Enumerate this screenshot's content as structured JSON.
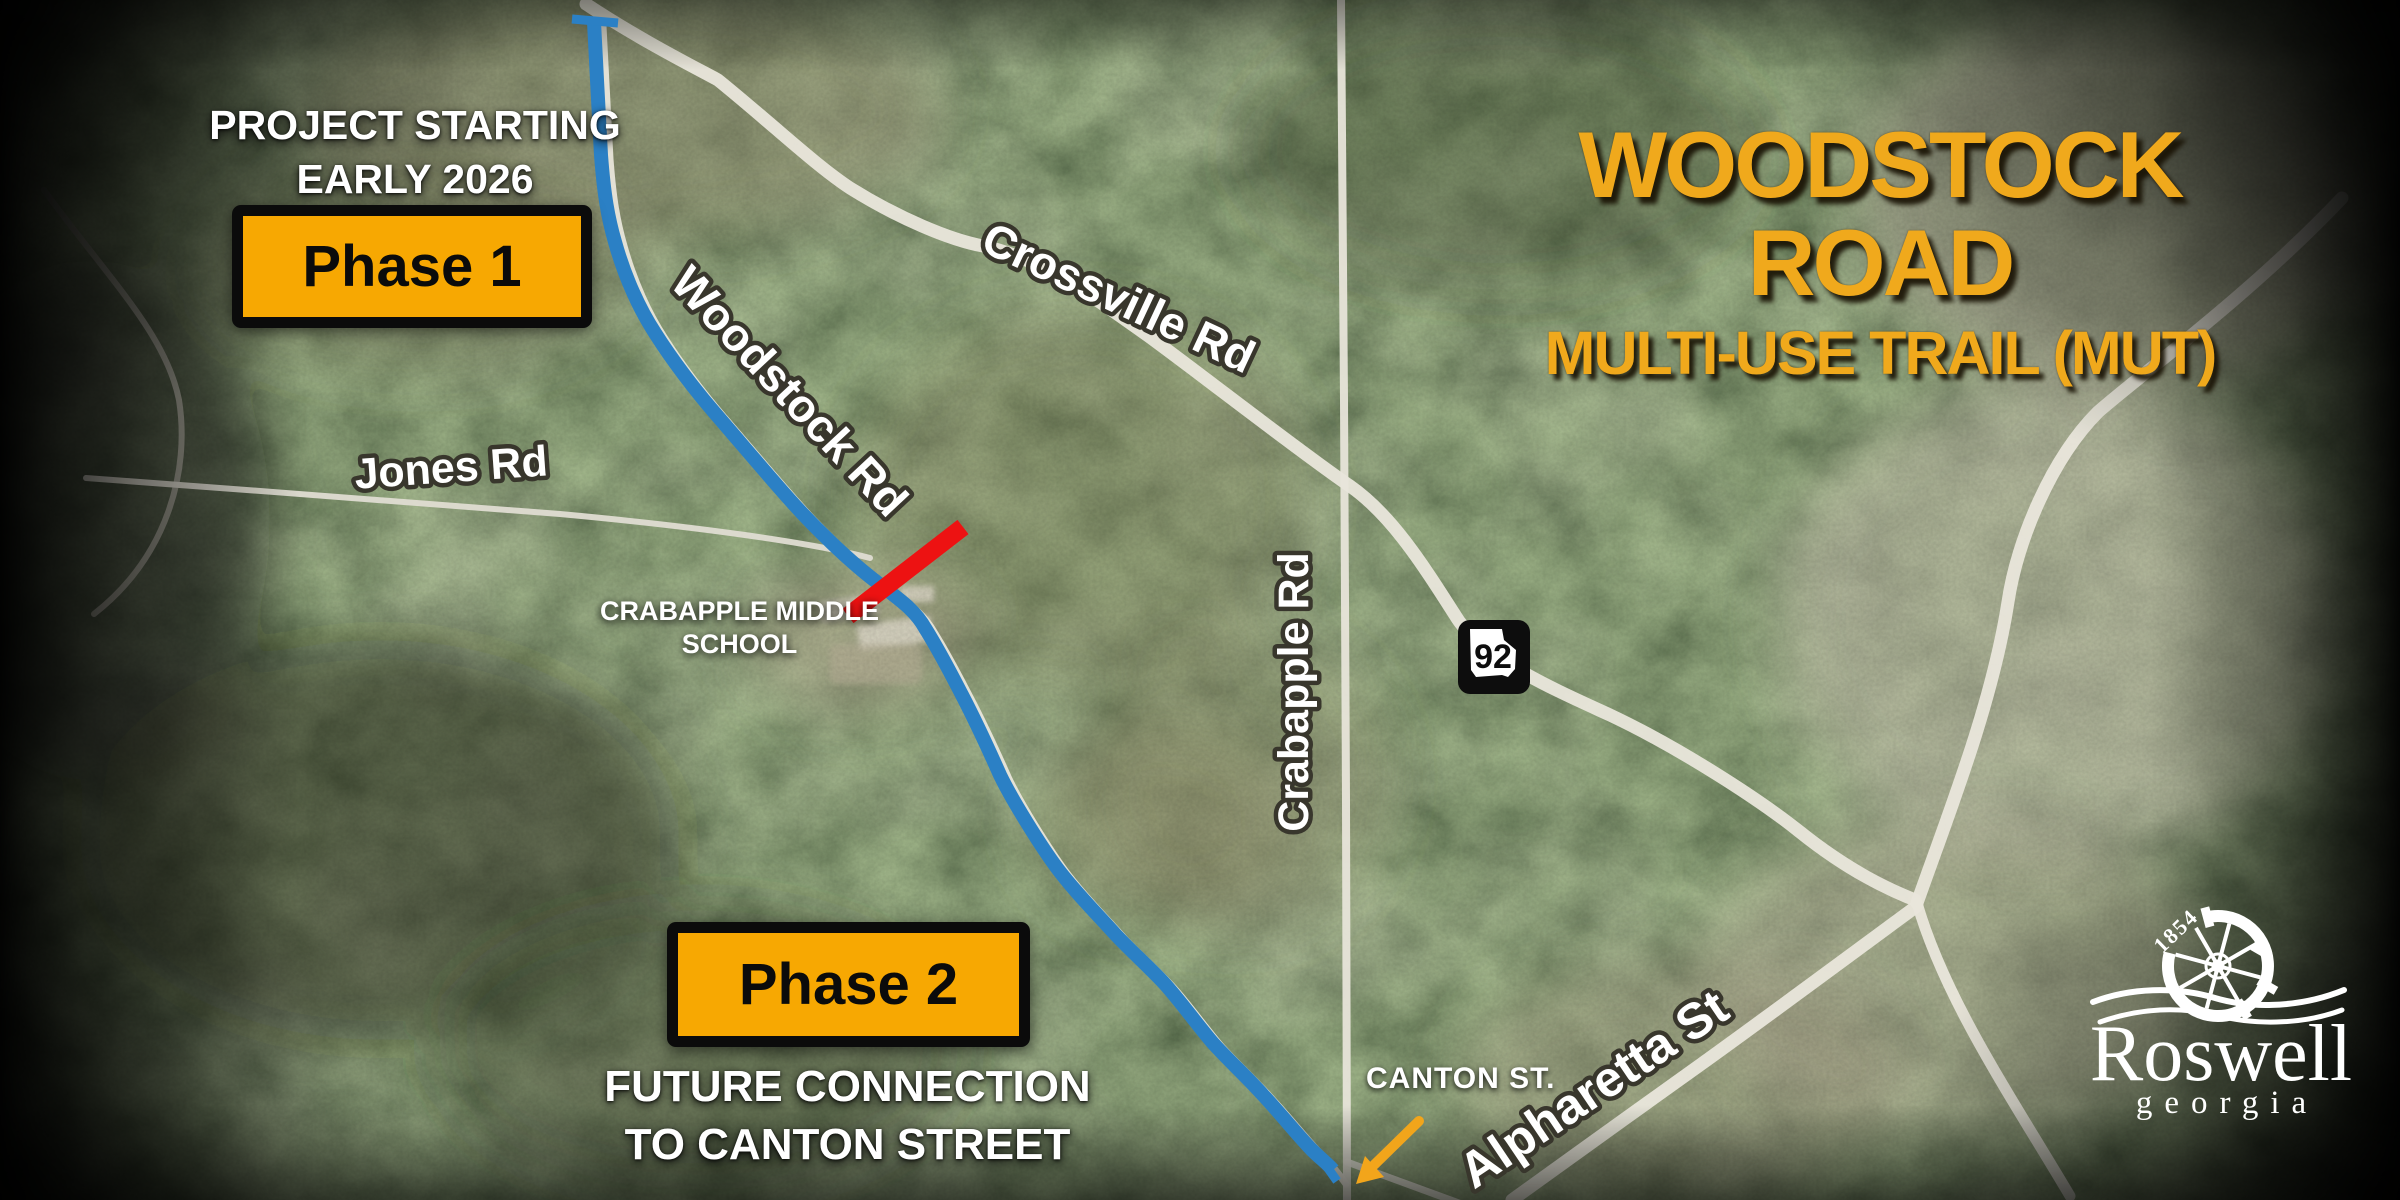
{
  "title": {
    "line1": "WOODSTOCK ROAD",
    "line2": "MULTI-USE TRAIL (MUT)"
  },
  "notes": {
    "project_start_line1": "PROJECT STARTING",
    "project_start_line2": "EARLY 2026",
    "future_line1": "FUTURE CONNECTION",
    "future_line2": "TO CANTON STREET"
  },
  "badges": {
    "phase1": "Phase 1",
    "phase2": "Phase 2"
  },
  "road_labels": {
    "crossville": "Crossville Rd",
    "woodstock": "Woodstock Rd",
    "jones": "Jones Rd",
    "crabapple": "Crabapple Rd",
    "alpharetta": "Alpharetta St",
    "canton": "CANTON ST."
  },
  "places": {
    "school_line1": "CRABAPPLE MIDDLE",
    "school_line2": "SCHOOL"
  },
  "highway_shield": {
    "route": "92"
  },
  "logo": {
    "year": "1854",
    "city": "Roswell",
    "state": "georgia"
  },
  "colors": {
    "trail_blue": "#2B80C5",
    "crossing_red": "#ED1212",
    "arrow_orange": "#F2A51B",
    "badge_yellow": "#F7A802",
    "title_gold": "#F0A91C"
  }
}
